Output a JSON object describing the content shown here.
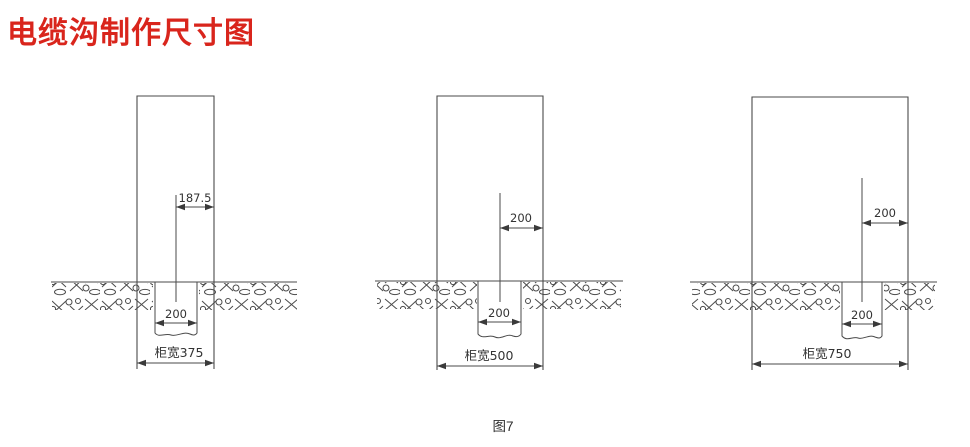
{
  "title": {
    "text": "电缆沟制作尺寸图",
    "color": "#d9251c"
  },
  "caption": "图7",
  "styles": {
    "line_color": "#4a4a4a",
    "text_color": "#333333",
    "background": "#ffffff"
  },
  "diagrams": [
    {
      "id": "cabinet-375",
      "center_offset_label": "187.5",
      "trench_width_label": "200",
      "cabinet_width_label": "柜宽375"
    },
    {
      "id": "cabinet-500",
      "center_offset_label": "200",
      "trench_width_label": "200",
      "cabinet_width_label": "柜宽500"
    },
    {
      "id": "cabinet-750",
      "center_offset_label": "200",
      "trench_width_label": "200",
      "cabinet_width_label": "柜宽750"
    }
  ]
}
